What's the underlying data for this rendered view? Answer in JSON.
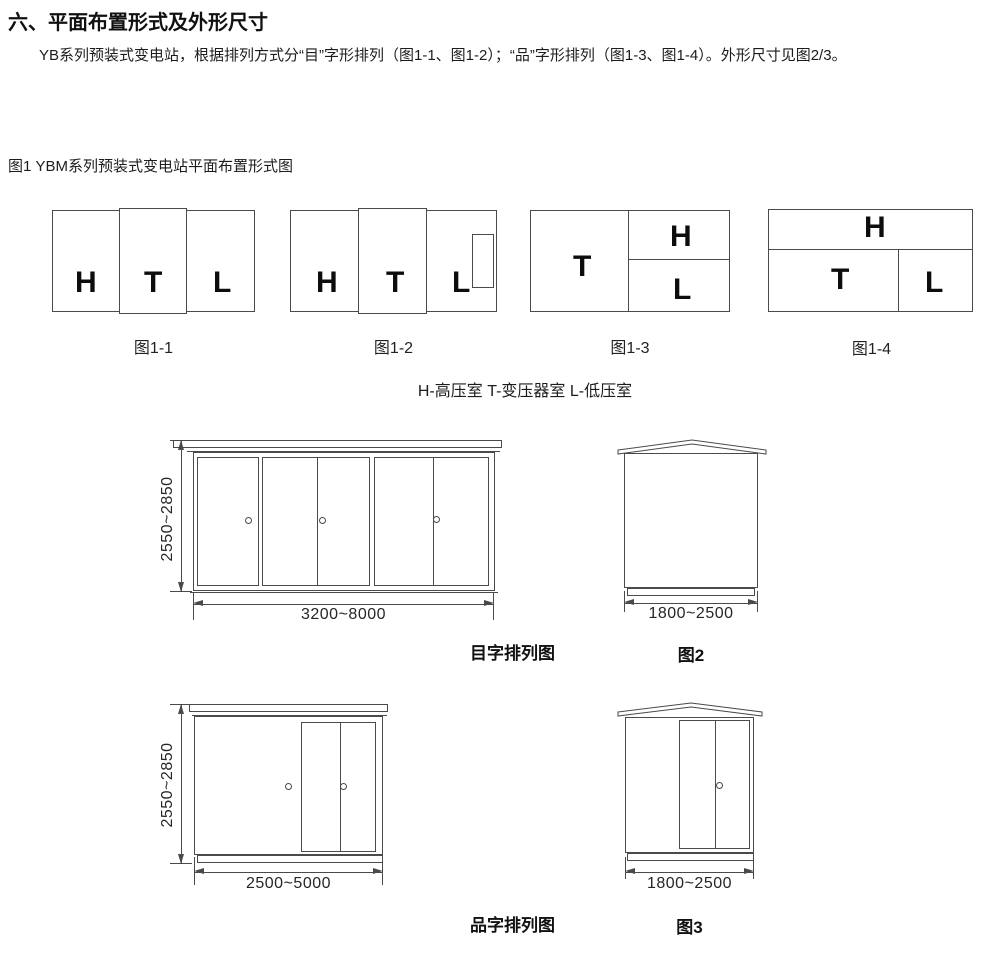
{
  "header": {
    "title": "六、平面布置形式及外形尺寸",
    "paragraph": "YB系列预装式变电站，根据排列方式分“目”字形排列（图1-1、图1-2）；“品”字形排列（图1-3、图1-4）。外形尺寸见图2/3。"
  },
  "figure1": {
    "label": "图1 YBM系列预装式变电站平面布置形式图",
    "legend": "H-高压室 T-变压器室 L-低压室",
    "diagrams": [
      {
        "caption": "图1-1",
        "rooms": [
          "H",
          "T",
          "L"
        ]
      },
      {
        "caption": "图1-2",
        "rooms": [
          "H",
          "T",
          "L"
        ]
      },
      {
        "caption": "图1-3",
        "rooms": [
          "T",
          "H",
          "L"
        ]
      },
      {
        "caption": "图1-4",
        "rooms": [
          "H",
          "T",
          "L"
        ]
      }
    ]
  },
  "elevations": {
    "mu": {
      "caption": "目字排列图",
      "height_dim": "2550~2850",
      "width_dim": "3200~8000"
    },
    "fig2": {
      "caption": "图2",
      "width_dim": "1800~2500"
    },
    "pin": {
      "caption": "品字排列图",
      "height_dim": "2550~2850",
      "width_dim": "2500~5000"
    },
    "fig3": {
      "caption": "图3",
      "width_dim": "1800~2500"
    }
  },
  "colors": {
    "line": "#4a4a4a",
    "text": "#1f1f1f"
  }
}
